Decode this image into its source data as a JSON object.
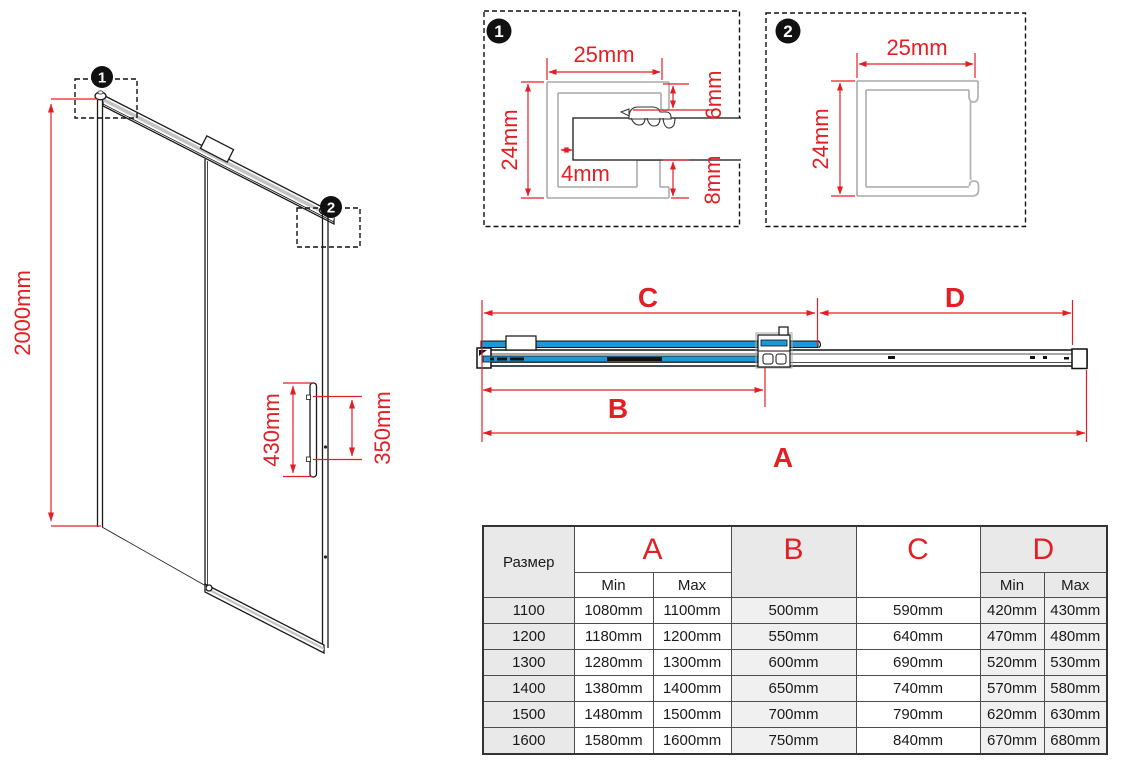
{
  "colors": {
    "accent_red": "#e31e24",
    "glass_blue": "#1f97d4",
    "profile_gray": "#b5b5b5"
  },
  "door_view": {
    "badge1": "1",
    "badge2": "2",
    "height_label": "2000mm",
    "handle_length_label": "430mm",
    "handle_holes_label": "350mm"
  },
  "detail_1": {
    "badge": "1",
    "width_label": "25mm",
    "height_label": "24mm",
    "top_lip_label": "6mm",
    "glass_gap_label": "4mm",
    "bottom_lip_label": "8mm"
  },
  "detail_2": {
    "badge": "2",
    "width_label": "25mm",
    "height_label": "24mm"
  },
  "top_view": {
    "dim_a": "A",
    "dim_b": "B",
    "dim_c": "C",
    "dim_d": "D"
  },
  "size_table": {
    "size_header": "Размер",
    "min_label": "Min",
    "max_label": "Max",
    "columns": {
      "a": "A",
      "b": "B",
      "c": "C",
      "d": "D"
    },
    "rows": [
      {
        "size": "1100",
        "a_min": "1080mm",
        "a_max": "1100mm",
        "b": "500mm",
        "c": "590mm",
        "d_min": "420mm",
        "d_max": "430mm"
      },
      {
        "size": "1200",
        "a_min": "1180mm",
        "a_max": "1200mm",
        "b": "550mm",
        "c": "640mm",
        "d_min": "470mm",
        "d_max": "480mm"
      },
      {
        "size": "1300",
        "a_min": "1280mm",
        "a_max": "1300mm",
        "b": "600mm",
        "c": "690mm",
        "d_min": "520mm",
        "d_max": "530mm"
      },
      {
        "size": "1400",
        "a_min": "1380mm",
        "a_max": "1400mm",
        "b": "650mm",
        "c": "740mm",
        "d_min": "570mm",
        "d_max": "580mm"
      },
      {
        "size": "1500",
        "a_min": "1480mm",
        "a_max": "1500mm",
        "b": "700mm",
        "c": "790mm",
        "d_min": "620mm",
        "d_max": "630mm"
      },
      {
        "size": "1600",
        "a_min": "1580mm",
        "a_max": "1600mm",
        "b": "750mm",
        "c": "840mm",
        "d_min": "670mm",
        "d_max": "680mm"
      }
    ]
  }
}
